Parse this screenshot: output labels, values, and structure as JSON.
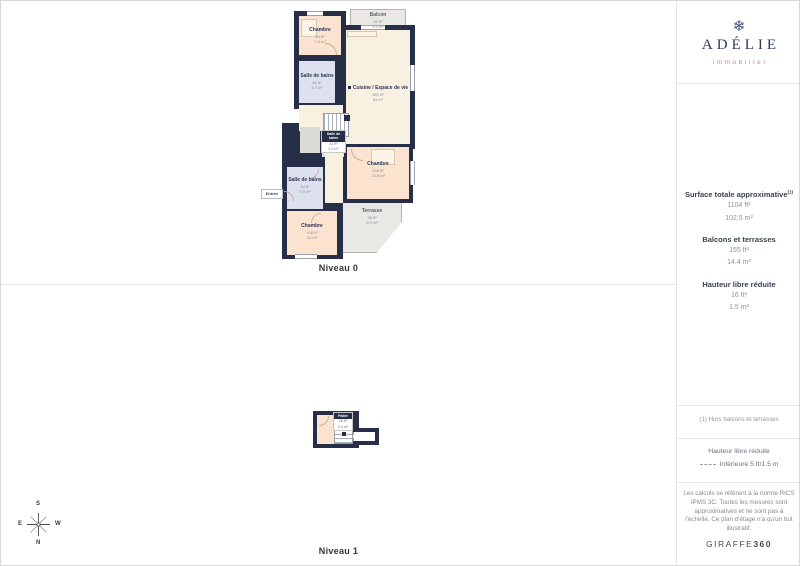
{
  "logo": {
    "glyph": "❄",
    "name": "ADÉLIE",
    "tagline": "immobilier"
  },
  "sidebar": {
    "metrics": [
      {
        "label": "Surface totale approximative",
        "sup": "(1)",
        "values": [
          "1104 ft²",
          "102,5 m²"
        ]
      },
      {
        "label": "Balcons et terrasses",
        "sup": "",
        "values": [
          "155 ft²",
          "14.4 m²"
        ]
      },
      {
        "label": "Hauteur libre réduite",
        "sup": "",
        "values": [
          "16 ft²",
          "1.5 m²"
        ]
      }
    ],
    "footnote": "(1) Hors balcons et terrasses",
    "legend": {
      "title": "Hauteur libre réduite",
      "item": "Inférieure 5 ft/1.5 m"
    },
    "disclaimer": "Les calculs se réfèrent à la norme RICS IPMS 3C. Toutes les mesures sont approximatives et ne sont pas à l'échelle. Ce plan d'étage n'a qu'un but illustratif.",
    "brand": {
      "name": "GIRAFFE",
      "suffix": "360"
    }
  },
  "levels": [
    {
      "label": "Niveau 0"
    },
    {
      "label": "Niveau 1"
    }
  ],
  "compass": {
    "top": "S",
    "right": "W",
    "bottom": "N",
    "left": "E"
  },
  "rooms": {
    "balcon": {
      "name": "Balcon",
      "ft": "59 ft²",
      "m": "5.5 m²"
    },
    "chambre_top": {
      "name": "Chambre",
      "ft": "84 ft²",
      "m": "7.8 m²"
    },
    "sdb_top": {
      "name": "Salle de bains",
      "ft": "61 ft²",
      "m": "5.7 m²"
    },
    "cuisine": {
      "name": "Cuisine / Espace de vie",
      "ft": "581 ft²",
      "m": "54 m²"
    },
    "sdb_small": {
      "name": "Salle de bains",
      "ft": "31 ft²",
      "m": "2.9 m²"
    },
    "chambre_right": {
      "name": "Chambre",
      "ft": "148 ft²",
      "m": "13.8 m²"
    },
    "sdb_left": {
      "name": "Salle de bains",
      "ft": "64 ft²",
      "m": "5.9 m²"
    },
    "chambre_bottom": {
      "name": "Chambre",
      "ft": "108 ft²",
      "m": "10 m²"
    },
    "terrasse": {
      "name": "Terrasse",
      "ft": "96 ft²",
      "m": "8.9 m²"
    },
    "entree": {
      "name": "Entrée"
    },
    "palier": {
      "name": "Palier",
      "ft": "25 ft²",
      "m": "2.4 m²"
    }
  },
  "colors": {
    "wall": "#272e48",
    "accent_pink": "#c9868d",
    "logo_navy": "#2e3a5c"
  }
}
